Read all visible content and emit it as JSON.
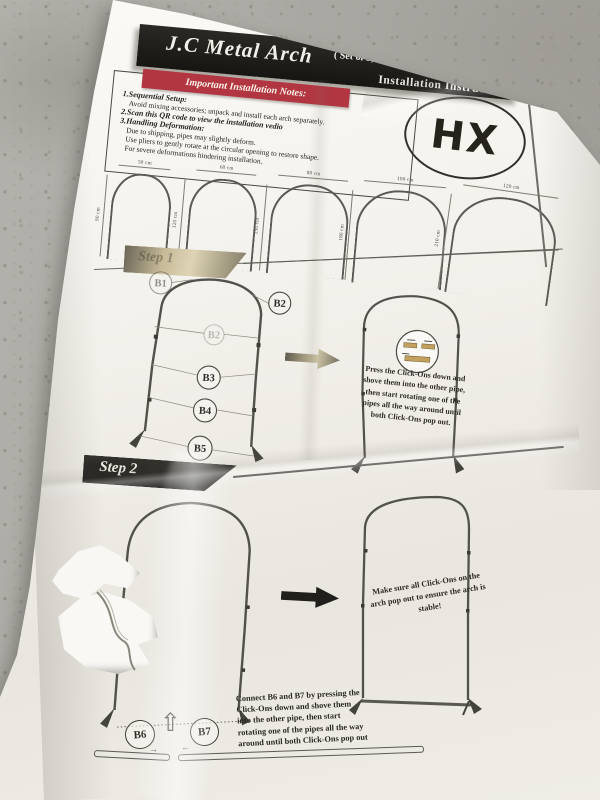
{
  "header": {
    "title": "J.C Metal Arch",
    "set_info": "( Set of 5,  3FT/4FT/5FT/6FT/7FT )",
    "subtitle": "Installation Instructions"
  },
  "notes": {
    "banner": "Important Installation Notes:",
    "lines": [
      "1.Sequential Setup:",
      "Avoid mixing accessories; unpack and install each arch separately.",
      "2.Scan this QR code to view the installation vedio",
      "3.Handling Deformation:",
      "Due to shipping, pipes may slightly deform.",
      "Use pliers to gently rotate at the circular opening to restore shape.",
      "For severe deformations hindering installation."
    ]
  },
  "logo": "HX",
  "size_chart": {
    "arches": [
      {
        "width": "50 cm",
        "height": "90 cm"
      },
      {
        "width": "60 cm",
        "height": "120 cm"
      },
      {
        "width": "80 cm",
        "height": "150 cm"
      },
      {
        "width": "100 cm",
        "height": "180 cm"
      },
      {
        "width": "120 cm",
        "height": "210 cm"
      }
    ]
  },
  "step1": {
    "label": "Step 1",
    "parts": [
      "B1",
      "B2",
      "B2",
      "B3",
      "B4",
      "B5"
    ],
    "instruction": "Press the Click-Ons down and shove them into the other pipe, then start rotating one of the pipes all the way around until both Click-Ons pop out."
  },
  "step2": {
    "label": "Step 2",
    "parts": [
      "B6",
      "B7"
    ],
    "connect_instruction": "Connect B6 and B7 by pressing the Click-Ons down and shove them into the other pipe, then start rotating one of the pipes all the way around until both Click-Ons pop out",
    "stability_note": "Make sure all Click-Ons on the arch pop out to ensure the arch is stable!"
  },
  "icons": {
    "up_arrow": "⇧",
    "arrow_right": "→",
    "arrow_left": "←"
  },
  "colors": {
    "banner_red": "#b23642",
    "band_black": "#1d1c19",
    "paper": "#f2f0ea",
    "floor_gray": "#a9a7a1",
    "ink": "#2b2925",
    "diagram_line": "#55534d",
    "pipe_tan": "#c2a05e"
  }
}
